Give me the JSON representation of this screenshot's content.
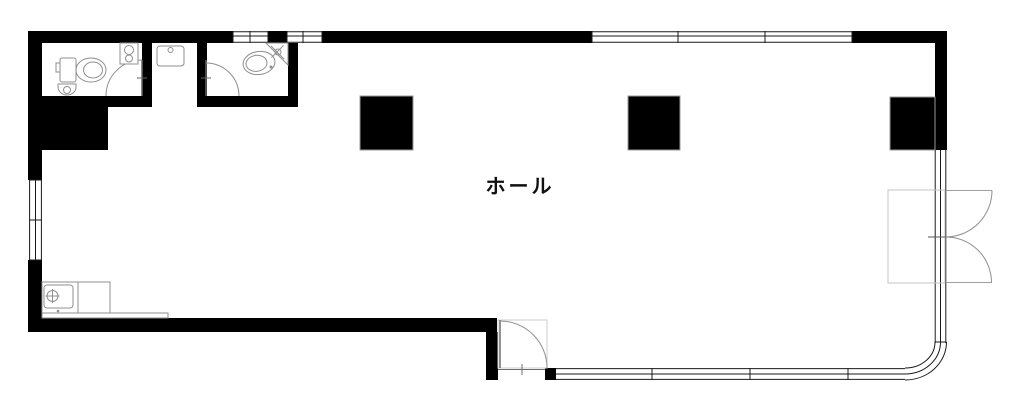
{
  "floorplan": {
    "hall_label": "ホール",
    "colors": {
      "wall": "#000000",
      "window_line": "#1a1a1a",
      "fixture_line": "#8f8f8f",
      "door_line": "#8f8f8f",
      "background": "#ffffff"
    },
    "fixtures": [
      "toilet-icon",
      "toilet-icon",
      "hand-wash-unit-icon",
      "wall-basin-icon",
      "vanity-basin-icon",
      "corner-basin-icon",
      "kitchen-sink-icon"
    ],
    "openings": [
      "toilet-door-left",
      "toilet-door-right",
      "entry-swing-door",
      "double-entrance-door"
    ]
  }
}
